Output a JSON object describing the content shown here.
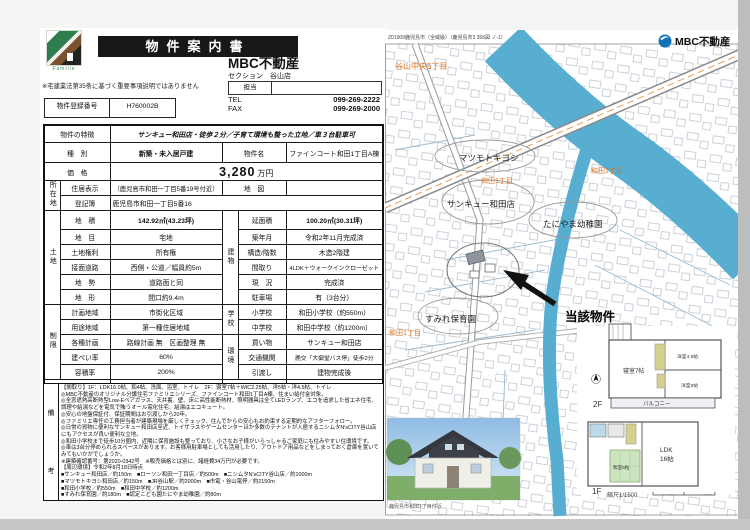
{
  "page": {
    "logo_brand": "Familie",
    "title": "物件案内書",
    "disclaimer": "※宅建業法第35条に基づく重要事項説明ではありません",
    "company": "MBC不動産",
    "section": "セクション　谷山店",
    "contact_label": "担当",
    "tel_label": "TEL",
    "tel": "099-269-2222",
    "fax_label": "FAX",
    "fax": "099-269-2000",
    "reg_label": "物件登録番号",
    "reg_no": "H760002B"
  },
  "t": {
    "feat_l": "物件の特徴",
    "feat_v": "サンキュー和田店・徒歩２分／子育て環境も整った立地／車３台駐車可",
    "type_l": "種　別",
    "type_v": "新築・未入居戸建",
    "name_l": "物件名",
    "name_v": "ファインコート和田1丁目A棟",
    "price_l": "価　格",
    "price_n": "3,280",
    "price_u": "万円",
    "loc_g": "所在地",
    "loc1_l": "住居表示",
    "loc1_v": "（鹿児島市和田一丁目5番19号付近）",
    "map_l": "地　図",
    "map_v": "",
    "loc2_l": "登記簿",
    "loc2_v": "鹿児島市和田一丁目5番16",
    "land_g": "土地",
    "land": [
      {
        "l": "地　積",
        "v": "142.92㎡(43.23坪)"
      },
      {
        "l": "地　目",
        "v": "宅地"
      },
      {
        "l": "土地権利",
        "v": "所有権"
      },
      {
        "l": "接面道路",
        "v": "西側・公道／幅員約5m"
      },
      {
        "l": "地　勢",
        "v": "道路面と同"
      },
      {
        "l": "地　形",
        "v": "間口約9.4m"
      }
    ],
    "bld_g": "建物",
    "bld": [
      {
        "l": "延面積",
        "v": "100.20㎡(30.31坪)"
      },
      {
        "l": "築年月",
        "v": "令和2年11月完成済"
      },
      {
        "l": "構造/階数",
        "v": "木造2階建"
      },
      {
        "l": "間取り",
        "v": "4LDK＋ウォークインクローゼット"
      },
      {
        "l": "現　況",
        "v": "完成済"
      },
      {
        "l": "駐車場",
        "v": "有（3台分）"
      }
    ],
    "reg_g": "制限",
    "reg": [
      {
        "l": "計画地域",
        "v": "市街化区域"
      },
      {
        "l": "用途地域",
        "v": "第一種住居地域"
      },
      {
        "l": "各種計画",
        "v": "路線計画 無　区画整理 無"
      },
      {
        "l": "建ぺい率",
        "v": "60%"
      },
      {
        "l": "容積率",
        "v": "200%"
      }
    ],
    "sch_g": "学校",
    "env_g": "環境",
    "env": [
      {
        "l": "小学校",
        "v": "和田小学校（約550m）"
      },
      {
        "l": "中学校",
        "v": "和田中学校（約1200m）"
      },
      {
        "l": "買い物",
        "v": "サンキュー和田店"
      },
      {
        "l": "交通機関",
        "v": "鹿交「大御堂バス停」徒歩2分"
      },
      {
        "l": "引渡し",
        "v": "建物完成後"
      }
    ],
    "deal_l": "取引態様",
    "deal_v": "売主",
    "fee_l": "仲介手数料",
    "fee_v": "不要",
    "notes_g1": "備",
    "notes_g2": "考",
    "notes": [
      "【間取り】1F：LDK16.0帖、和4帖、洗面、浴室、トイレ　2F：寝室7帖＋WIC2.25帖、洋5帖・洋4.5帖、トイレ",
      "◎MBC不動産のオリジナル分譲住宅ファミリエシリーズ、ファインコート和田1丁目A棟、住まい給付金対象。",
      "◎全窓遮熱高断熱型Low-Eペアガラス、天井裏、壁、床に高性能断熱材、照明器具は全てLEDランプ、エコを追求した省エネ住宅、調理や給湯などを電気で賄うオール電化住宅、給湯はエコキュート。",
      "◎安心の地盤保証付、保証期間はお引渡しから20年。",
      "◎ファミリエ専任の工務担当者が建築現場を厳しくチェック、住んでからの安心もお約束する定期的なアフターフォロー。",
      "◎日常の買物に便利なサンキュー和田店至近、トイザラスやゲームセンターほか多数のテナントが入居するニシムタN'sCITY谷山店にもアクセスが良い便利な立地。",
      "◎和田小学校まで徒歩10分圏内、近隣に保育施設も整っており、小さなお子様がいらっしゃるご家庭にも住みやすい住環境です。",
      "◎車は3台分停められるスペースがあります。お客様用駐車場としても活用したり、アウトドア用品などをしまっておく倉庫を置いてみてもいかがでしょうか。",
      "※建築確認番号：第2020-0342号　※販売価格とは別に、諸経費34万円が必要です。",
      "【周辺環境】令和2年8月18日時点",
      "■サンキュー和田店／約150m　■ローソン和田一丁目店／約500m　■ニシムタN'sCITY谷山店／約1000m",
      "■マツモトキヨシ和田店／約150m　■JR谷山駅／約2000m　■市電・谷山電停／約2150m",
      "■和田小学校／約550m　■和田中学校／約1200m",
      "■すみれ保育園／約180m　■認定こども園たにやま幼稚園／約80m"
    ]
  },
  "map": {
    "ref": "Z01909鹿児島市（全域版）〔鹿児島市3 356図 ノ-1〕",
    "logo": "MBC不動産",
    "area1": "谷山中央5丁目",
    "area2": "和田1丁目",
    "area3": "和田1丁目",
    "area4": "和田1丁目",
    "poi_matsumoto": "マツモトキヨシ",
    "poi_sankyu": "サンキュー和田店",
    "poi_taniyama": "たにやま幼稚園",
    "poi_sumire": "すみれ保育園",
    "subject": "当該物件",
    "fp": {
      "f2": "2F",
      "f1": "1F",
      "r2_main": "寝室7帖",
      "r2_a": "洋室4.5帖",
      "r2_b": "洋室5帖",
      "balcony": "バルコニー",
      "r1_ldk": "LDK",
      "r1_ldk2": "16帖",
      "r1_wa": "和室6帖",
      "scale": "縮尺1/1500"
    },
    "photo_caption": "鹿児島市和田1丁目付近"
  },
  "colors": {
    "river": "#57aed1",
    "orange_label": "#e0741f",
    "mbc_blue": "#1273b8",
    "title_bg": "#181818"
  }
}
